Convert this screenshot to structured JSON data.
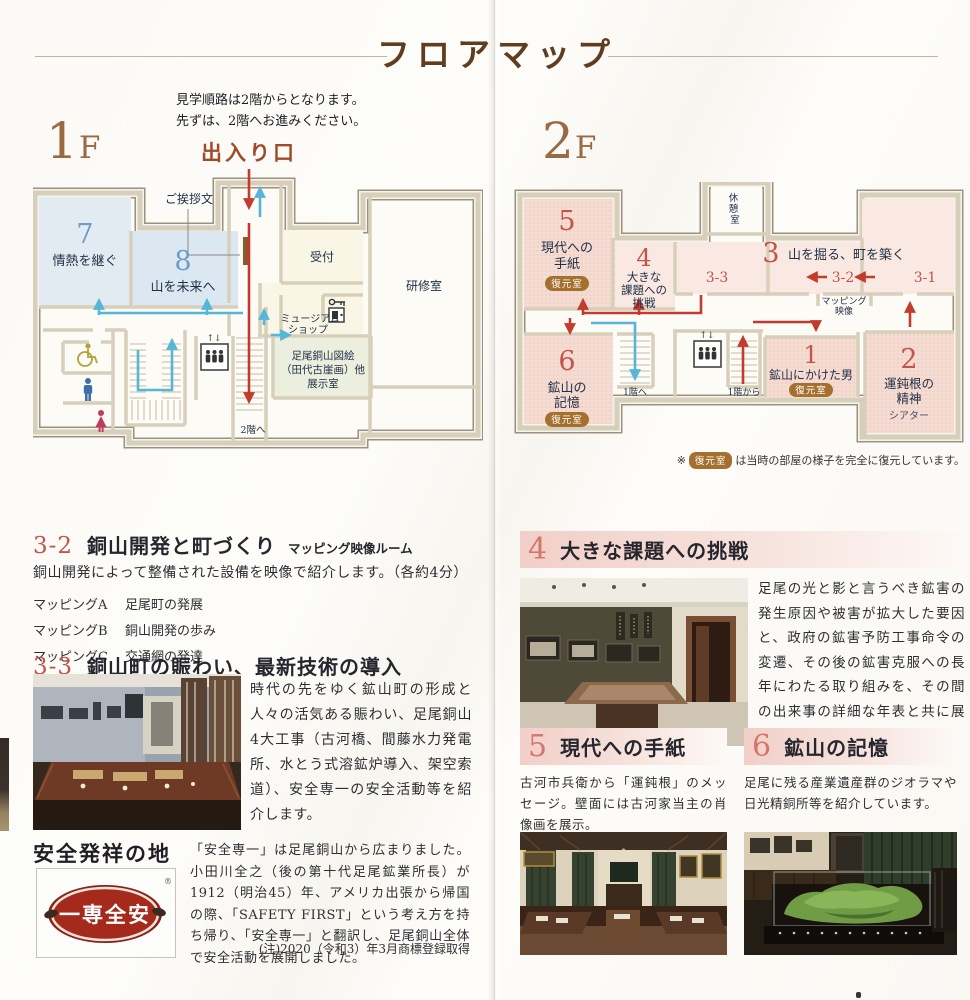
{
  "page": {
    "title": "フロアマップ",
    "notice_line1": "見学順路は2階からとなります。",
    "notice_line2": "先ずは、2階へお進みください。",
    "entrance_label": "出入り口",
    "floor1_label": "1F",
    "floor2_label": "2F"
  },
  "colors": {
    "title_brown": "#5f3d20",
    "floor_label_brown": "#9a6a44",
    "entrance_red": "#a04a28",
    "route_red": "#c23b2e",
    "route_blue": "#56b6d8",
    "number_red": "#c5534a",
    "number_blue": "#6f9cc5",
    "room_pink": "#f5dcd3",
    "room_pink_light": "#f9e9e2",
    "room_blue": "#dfe9f1",
    "room_green": "#ecefdd",
    "room_cream": "#faf6e6",
    "wall_beige": "#d7cfba",
    "restored_badge_brown": "#a5702e",
    "section_number_pink": "#d4766c"
  },
  "floor1": {
    "greeting": "ご挨拶文",
    "room7_num": "7",
    "room7_name": "情熱を継ぐ",
    "room8_num": "8",
    "room8_name": "山を未来へ",
    "reception": "受付",
    "shop_line1": "ミュージアム",
    "shop_line2": "ショップ",
    "training": "研修室",
    "exhibit_line1": "足尾銅山図絵",
    "exhibit_line2": "（田代古崖画）他",
    "exhibit_line3": "展示室",
    "to_2f": "2階へ",
    "elevator_arrows": "↑↓"
  },
  "floor2": {
    "rest_line1": "休",
    "rest_line2": "憩",
    "rest_line3": "室",
    "room5_num": "5",
    "room5_line1": "現代への",
    "room5_line2": "手紙",
    "room4_num": "4",
    "room4_line1": "大きな",
    "room4_line2": "課題への",
    "room4_line3": "挑戦",
    "room3_num": "3",
    "room3_name": "山を掘る、町を築く",
    "zone33": "3-3",
    "zone32": "3-2",
    "zone31": "3-1",
    "mapping_line1": "マッピング",
    "mapping_line2": "映像",
    "room6_num": "6",
    "room6_line1": "鉱山の",
    "room6_line2": "記憶",
    "room1_num": "1",
    "room1_name": "鉱山にかけた男",
    "room2_num": "2",
    "room2_line1": "運鈍根の",
    "room2_line2": "精神",
    "room2_line3": "シアター",
    "restored": "復元室",
    "to_1f": "1階へ",
    "from_1f": "1階から",
    "elevator_arrows": "↑↓",
    "note_mark": "※",
    "note_badge": "復元室",
    "note_text": "は当時の部屋の様子を完全に復元しています。"
  },
  "sections": {
    "s32": {
      "num": "3-2",
      "title": "銅山開発と町づくり",
      "subtitle": "マッピング映像ルーム",
      "desc": "銅山開発によって整備された設備を映像で紹介します。（各約4分）",
      "items": [
        {
          "label": "マッピングA",
          "text": "足尾町の発展"
        },
        {
          "label": "マッピングB",
          "text": "銅山開発の歩み"
        },
        {
          "label": "マッピングC",
          "text": "交通網の発達"
        }
      ]
    },
    "s33": {
      "num": "3-3",
      "title": "銅山町の賑わい、最新技術の導入",
      "desc": "時代の先をゆく鉱山町の形成と人々の活気ある賑わい、足尾銅山4大工事（古河橋、間藤水力発電所、水とう式溶鉱炉導入、架空索道）、安全専一の安全活動等を紹介します。"
    },
    "safety": {
      "title": "安全発祥の地",
      "logo_text": "一専全安",
      "logo_reg": "®",
      "desc": "「安全専一」は足尾銅山から広まりました。小田川全之（後の第十代足尾鉱業所長）が1912（明治45）年、アメリカ出張から帰国の際、「SAFETY FIRST」という考え方を持ち帰り、「安全専一」と翻訳し、足尾銅山全体で安全活動を展開しました。",
      "note": "(注)2020（令和3）年3月商標登録取得"
    },
    "s4": {
      "num": "4",
      "title": "大きな課題への挑戦",
      "desc": "足尾の光と影と言うべき鉱害の発生原因や被害が拡大した要因と、政府の鉱害予防工事命令の変遷、その後の鉱害克服への長年にわたる取り組みを、その間の出来事の詳細な年表と共に展示しています。"
    },
    "s5": {
      "num": "5",
      "title": "現代への手紙",
      "desc": "古河市兵衛から「運鈍根」のメッセージ。壁面には古河家当主の肖像画を展示。"
    },
    "s6": {
      "num": "6",
      "title": "鉱山の記憶",
      "desc": "足尾に残る産業遺産群のジオラマや日光精銅所等を紹介しています。"
    }
  }
}
